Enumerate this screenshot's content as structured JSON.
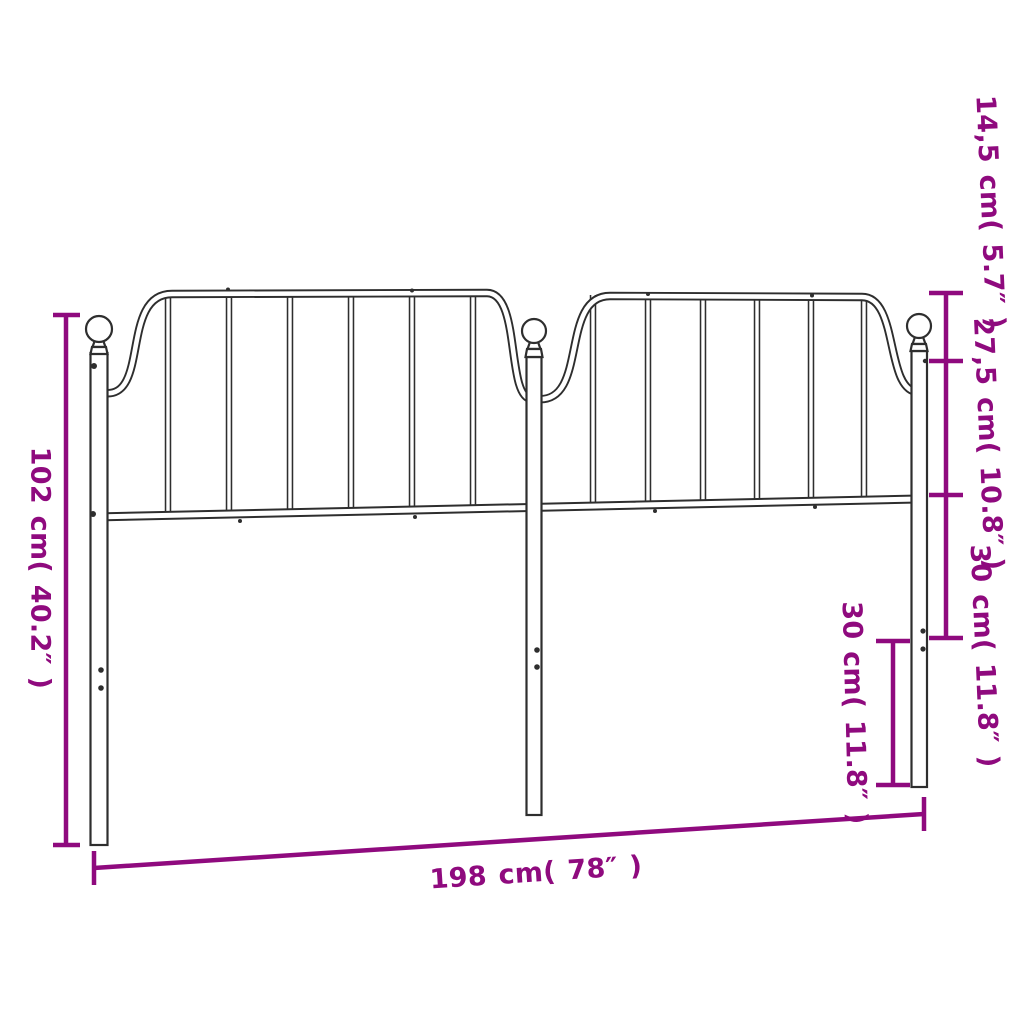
{
  "labels": {
    "total_height": "102 cm( 40.2″ )",
    "finial_drop": "14,5 cm( 5.7″ )",
    "panel_height": "27,5 cm( 10.8″ )",
    "rail_to_bracket": "30 cm( 11.8″ )",
    "bracket_to_leg_end": "30 cm( 11.8″ )",
    "total_width": "198 cm( 78″ )"
  },
  "dimensions": [
    {
      "name": "total_height",
      "cm": "102",
      "inches": "40.2"
    },
    {
      "name": "finial_drop",
      "cm": "14,5",
      "inches": "5.7"
    },
    {
      "name": "panel_height",
      "cm": "27,5",
      "inches": "10.8"
    },
    {
      "name": "rail_to_bracket",
      "cm": "30",
      "inches": "11.8"
    },
    {
      "name": "bracket_to_leg_end",
      "cm": "30",
      "inches": "11.8"
    },
    {
      "name": "total_width",
      "cm": "198",
      "inches": "78"
    }
  ],
  "colors": {
    "dimension": "#8F0A7E",
    "drawing": "#2e2e2e",
    "background": "#ffffff"
  }
}
